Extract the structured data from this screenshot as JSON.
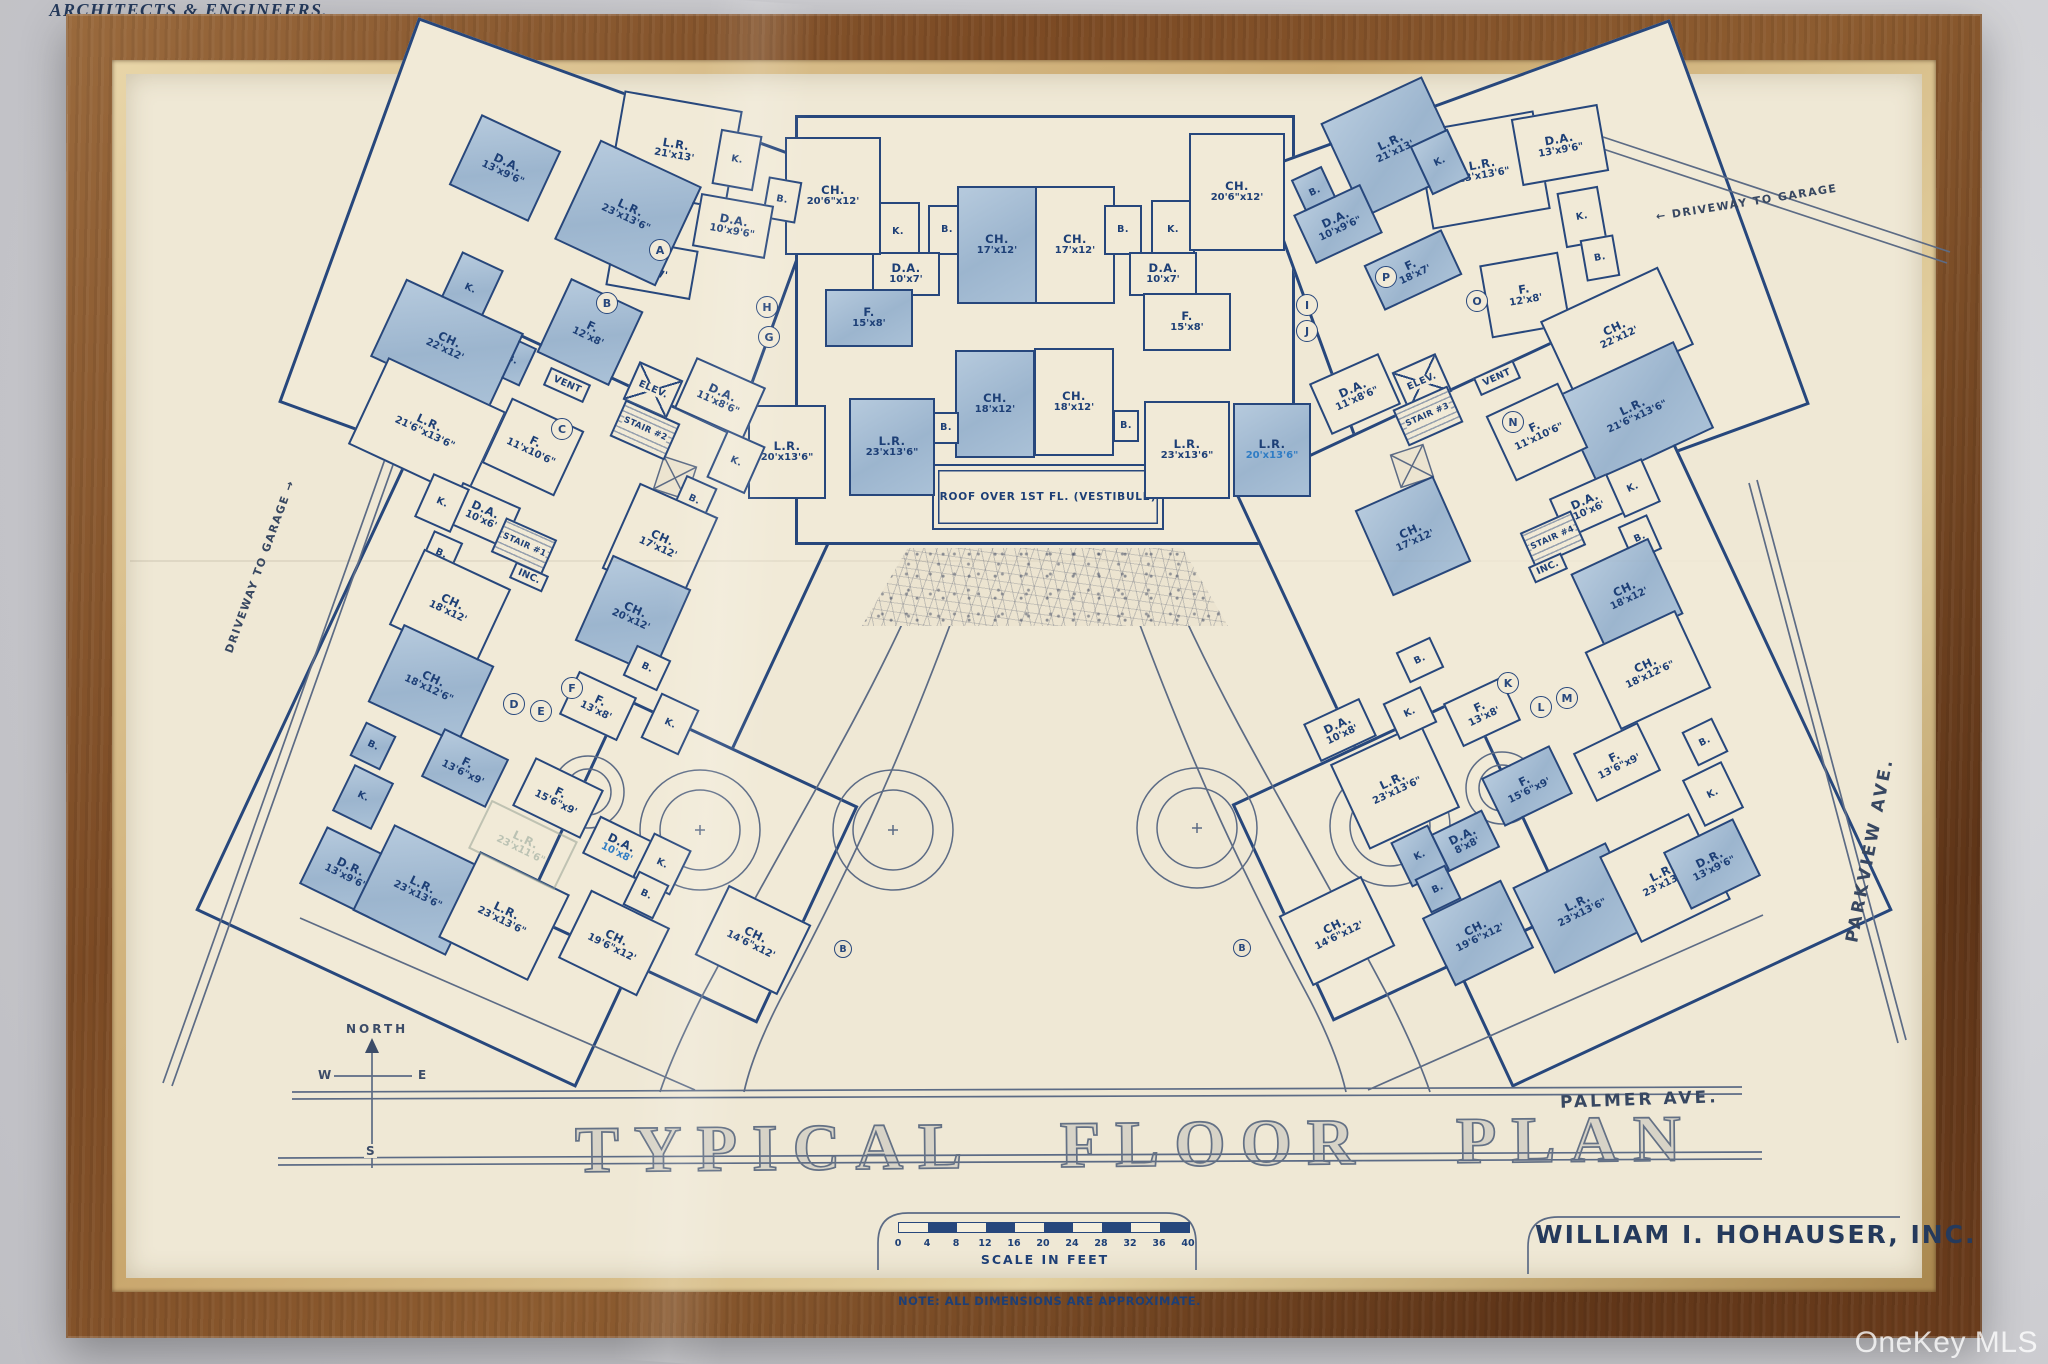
{
  "title": {
    "text": "TYPICAL FLOOR PLAN"
  },
  "firm": {
    "name": "WILLIAM I. HOHAUSER, INC.",
    "tagline": "ARCHITECTS & ENGINEERS,"
  },
  "note": "NOTE: ALL DIMENSIONS ARE APPROXIMATE.",
  "scale": {
    "label": "SCALE IN FEET",
    "ticks": [
      0,
      4,
      8,
      12,
      16,
      20,
      24,
      28,
      32,
      36,
      40
    ]
  },
  "streets": {
    "palmer": "PALMER AVE.",
    "parkview": "PARKVIEW AVE.",
    "driveway_right": "← DRIVEWAY TO GARAGE",
    "driveway_left": "DRIVEWAY TO GARAGE →"
  },
  "compass": {
    "north": "NORTH",
    "w": "W",
    "e": "E",
    "s": "S"
  },
  "vestibule": "ROOF OVER 1ST FL. (VESTIBULE)",
  "watermark": "OneKey MLS",
  "colors": {
    "ink": "#27477c",
    "wash": "#a7bed8",
    "paper": "#efe8d5",
    "wood": "#7b4a24"
  },
  "rooms": [
    {
      "x": 898,
      "y": 232,
      "w": 44,
      "h": 60,
      "a": 0,
      "s": "c",
      "l": "K."
    },
    {
      "x": 947,
      "y": 230,
      "w": 38,
      "h": 50,
      "a": 0,
      "s": "c",
      "l": "B."
    },
    {
      "x": 906,
      "y": 274,
      "w": 68,
      "h": 44,
      "a": 0,
      "s": "c",
      "l": "D.A.",
      "d": "10'x7'"
    },
    {
      "x": 997,
      "y": 245,
      "w": 80,
      "h": 118,
      "a": 0,
      "s": "b",
      "l": "CH.",
      "d": "17'x12'"
    },
    {
      "x": 1075,
      "y": 245,
      "w": 80,
      "h": 118,
      "a": 0,
      "s": "c",
      "l": "CH.",
      "d": "17'x12'"
    },
    {
      "x": 1123,
      "y": 230,
      "w": 38,
      "h": 50,
      "a": 0,
      "s": "c",
      "l": "B."
    },
    {
      "x": 1173,
      "y": 230,
      "w": 44,
      "h": 60,
      "a": 0,
      "s": "c",
      "l": "K."
    },
    {
      "x": 1163,
      "y": 274,
      "w": 68,
      "h": 44,
      "a": 0,
      "s": "c",
      "l": "D.A.",
      "d": "10'x7'"
    },
    {
      "x": 833,
      "y": 196,
      "w": 96,
      "h": 118,
      "a": 0,
      "s": "c",
      "l": "CH.",
      "d": "20'6\"x12'"
    },
    {
      "x": 1237,
      "y": 192,
      "w": 96,
      "h": 118,
      "a": 0,
      "s": "c",
      "l": "CH.",
      "d": "20'6\"x12'"
    },
    {
      "x": 869,
      "y": 318,
      "w": 88,
      "h": 58,
      "a": 0,
      "s": "b",
      "l": "F.",
      "d": "15'x8'"
    },
    {
      "x": 1187,
      "y": 322,
      "w": 88,
      "h": 58,
      "a": 0,
      "s": "c",
      "l": "F.",
      "d": "15'x8'"
    },
    {
      "x": 995,
      "y": 404,
      "w": 80,
      "h": 108,
      "a": 0,
      "s": "b",
      "l": "CH.",
      "d": "18'x12'"
    },
    {
      "x": 1074,
      "y": 402,
      "w": 80,
      "h": 108,
      "a": 0,
      "s": "c",
      "l": "CH.",
      "d": "18'x12'"
    },
    {
      "x": 946,
      "y": 428,
      "w": 26,
      "h": 32,
      "a": 0,
      "s": "c",
      "l": "B."
    },
    {
      "x": 1126,
      "y": 426,
      "w": 26,
      "h": 32,
      "a": 0,
      "s": "c",
      "l": "B."
    },
    {
      "x": 892,
      "y": 447,
      "w": 86,
      "h": 98,
      "a": 0,
      "s": "b",
      "l": "L.R.",
      "d": "23'x13'6\""
    },
    {
      "x": 1187,
      "y": 450,
      "w": 86,
      "h": 98,
      "a": 0,
      "s": "c",
      "l": "L.R.",
      "d": "23'x13'6\""
    },
    {
      "x": 787,
      "y": 452,
      "w": 78,
      "h": 94,
      "a": 0,
      "s": "c",
      "l": "L.R.",
      "d": "20'x13'6\""
    },
    {
      "x": 1272,
      "y": 450,
      "w": 78,
      "h": 94,
      "a": 0,
      "s": "b",
      "l": "L.R.",
      "d": "20'x13'6\"",
      "corr": true
    },
    {
      "x": 675,
      "y": 150,
      "w": 120,
      "h": 100,
      "a": 10,
      "s": "c",
      "l": "L.R.",
      "d": "21'x13'"
    },
    {
      "x": 737,
      "y": 160,
      "w": 42,
      "h": 56,
      "a": 10,
      "s": "c",
      "l": "K."
    },
    {
      "x": 782,
      "y": 200,
      "w": 34,
      "h": 42,
      "a": 10,
      "s": "c",
      "l": "B."
    },
    {
      "x": 733,
      "y": 226,
      "w": 74,
      "h": 54,
      "a": 10,
      "s": "c",
      "l": "D.A.",
      "d": "10'x9'6\""
    },
    {
      "x": 652,
      "y": 268,
      "w": 86,
      "h": 50,
      "a": 10,
      "s": "c",
      "l": "F.",
      "d": "18'x7'"
    },
    {
      "x": 505,
      "y": 168,
      "w": 88,
      "h": 78,
      "a": 25,
      "s": "b",
      "l": "D.A.",
      "d": "13'x9'6\""
    },
    {
      "x": 628,
      "y": 213,
      "w": 112,
      "h": 110,
      "a": 25,
      "s": "b",
      "l": "L.R.",
      "d": "23'x13'6\""
    },
    {
      "x": 470,
      "y": 289,
      "w": 46,
      "h": 62,
      "a": 25,
      "s": "b",
      "l": "K."
    },
    {
      "x": 512,
      "y": 360,
      "w": 36,
      "h": 42,
      "a": 25,
      "s": "b",
      "l": "B."
    },
    {
      "x": 590,
      "y": 332,
      "w": 80,
      "h": 82,
      "a": 25,
      "s": "b",
      "l": "F.",
      "d": "12'x8'"
    },
    {
      "x": 447,
      "y": 345,
      "w": 130,
      "h": 86,
      "a": 25,
      "s": "b",
      "l": "CH.",
      "d": "22'x12'"
    },
    {
      "x": 427,
      "y": 428,
      "w": 130,
      "h": 96,
      "a": 25,
      "s": "c",
      "l": "L.R.",
      "d": "21'6\"x13'6\""
    },
    {
      "x": 533,
      "y": 447,
      "w": 80,
      "h": 72,
      "a": 25,
      "s": "c",
      "l": "F.",
      "d": "11'x10'6\""
    },
    {
      "x": 567,
      "y": 385,
      "w": 44,
      "h": 20,
      "a": 24,
      "s": "v",
      "l": "VENT"
    },
    {
      "x": 653,
      "y": 390,
      "w": 48,
      "h": 42,
      "a": 24,
      "s": "e",
      "l": "ELEV."
    },
    {
      "x": 645,
      "y": 430,
      "w": 60,
      "h": 40,
      "a": 24,
      "s": "t",
      "l": "STAIR #2"
    },
    {
      "x": 720,
      "y": 398,
      "w": 76,
      "h": 56,
      "a": 24,
      "s": "c",
      "l": "D.A.",
      "d": "11'x8'6\""
    },
    {
      "x": 736,
      "y": 462,
      "w": 42,
      "h": 52,
      "a": 24,
      "s": "c",
      "l": "K."
    },
    {
      "x": 694,
      "y": 500,
      "w": 34,
      "h": 40,
      "a": 24,
      "s": "c",
      "l": "B."
    },
    {
      "x": 660,
      "y": 543,
      "w": 86,
      "h": 94,
      "a": 24,
      "s": "c",
      "l": "CH.",
      "d": "17'x12'"
    },
    {
      "x": 633,
      "y": 615,
      "w": 86,
      "h": 94,
      "a": 24,
      "s": "b",
      "l": "CH.",
      "d": "20'x12'"
    },
    {
      "x": 483,
      "y": 515,
      "w": 64,
      "h": 44,
      "a": 24,
      "s": "c",
      "l": "D.A.",
      "d": "10'x6'"
    },
    {
      "x": 442,
      "y": 503,
      "w": 40,
      "h": 48,
      "a": 24,
      "s": "c",
      "l": "K."
    },
    {
      "x": 441,
      "y": 554,
      "w": 32,
      "h": 38,
      "a": 24,
      "s": "c",
      "l": "B."
    },
    {
      "x": 524,
      "y": 546,
      "w": 56,
      "h": 38,
      "a": 24,
      "s": "t",
      "l": "STAIR #1"
    },
    {
      "x": 529,
      "y": 577,
      "w": 36,
      "h": 18,
      "a": 24,
      "s": "v",
      "l": "INC."
    },
    {
      "x": 450,
      "y": 607,
      "w": 96,
      "h": 84,
      "a": 25,
      "s": "c",
      "l": "CH.",
      "d": "18'x12'"
    },
    {
      "x": 431,
      "y": 684,
      "w": 100,
      "h": 86,
      "a": 25,
      "s": "b",
      "l": "CH.",
      "d": "18'x12'6\""
    },
    {
      "x": 373,
      "y": 746,
      "w": 34,
      "h": 38,
      "a": 26,
      "s": "b",
      "l": "B."
    },
    {
      "x": 363,
      "y": 797,
      "w": 44,
      "h": 52,
      "a": 26,
      "s": "b",
      "l": "K."
    },
    {
      "x": 348,
      "y": 872,
      "w": 78,
      "h": 64,
      "a": 26,
      "s": "b",
      "l": "D.R.",
      "d": "13'x9'6\""
    },
    {
      "x": 420,
      "y": 890,
      "w": 104,
      "h": 96,
      "a": 26,
      "s": "b",
      "l": "L.R.",
      "d": "23'x13'6\""
    },
    {
      "x": 504,
      "y": 916,
      "w": 100,
      "h": 96,
      "a": 26,
      "s": "c",
      "l": "L.R.",
      "d": "23'x13'6\""
    },
    {
      "x": 523,
      "y": 845,
      "w": 96,
      "h": 54,
      "a": 26,
      "s": "g",
      "l": "L.R.",
      "d": "23'x11'6\""
    },
    {
      "x": 465,
      "y": 768,
      "w": 72,
      "h": 54,
      "a": 26,
      "s": "b",
      "l": "F.",
      "d": "13'6\"x9'"
    },
    {
      "x": 558,
      "y": 798,
      "w": 76,
      "h": 54,
      "a": 26,
      "s": "c",
      "l": "F.",
      "d": "15'6\"x9'"
    },
    {
      "x": 619,
      "y": 848,
      "w": 62,
      "h": 42,
      "a": 26,
      "s": "c",
      "l": "D.A.",
      "d": "10'x8'",
      "corr": true
    },
    {
      "x": 662,
      "y": 864,
      "w": 42,
      "h": 50,
      "a": 26,
      "s": "c",
      "l": "K."
    },
    {
      "x": 646,
      "y": 895,
      "w": 34,
      "h": 38,
      "a": 26,
      "s": "c",
      "l": "B."
    },
    {
      "x": 614,
      "y": 943,
      "w": 88,
      "h": 76,
      "a": 26,
      "s": "c",
      "l": "CH.",
      "d": "19'6\"x12'"
    },
    {
      "x": 753,
      "y": 940,
      "w": 92,
      "h": 78,
      "a": 26,
      "s": "c",
      "l": "CH.",
      "d": "14'6\"x12'"
    },
    {
      "x": 598,
      "y": 706,
      "w": 64,
      "h": 48,
      "a": 25,
      "s": "c",
      "l": "F.",
      "d": "13'x8'"
    },
    {
      "x": 670,
      "y": 724,
      "w": 42,
      "h": 50,
      "a": 25,
      "s": "c",
      "l": "K."
    },
    {
      "x": 647,
      "y": 668,
      "w": 38,
      "h": 34,
      "a": 25,
      "s": "c",
      "l": "B."
    },
    {
      "x": 1483,
      "y": 170,
      "w": 120,
      "h": 100,
      "a": -10,
      "s": "c",
      "l": "L.R.",
      "d": "23'x13'6\""
    },
    {
      "x": 1560,
      "y": 145,
      "w": 88,
      "h": 68,
      "a": -10,
      "s": "c",
      "l": "D.A.",
      "d": "13'x9'6\""
    },
    {
      "x": 1582,
      "y": 217,
      "w": 42,
      "h": 56,
      "a": -10,
      "s": "c",
      "l": "K."
    },
    {
      "x": 1600,
      "y": 258,
      "w": 34,
      "h": 42,
      "a": -10,
      "s": "c",
      "l": "B."
    },
    {
      "x": 1525,
      "y": 295,
      "w": 80,
      "h": 74,
      "a": -10,
      "s": "c",
      "l": "F.",
      "d": "12'x8'"
    },
    {
      "x": 1617,
      "y": 333,
      "w": 130,
      "h": 86,
      "a": -25,
      "s": "c",
      "l": "CH.",
      "d": "22'x12'"
    },
    {
      "x": 1393,
      "y": 147,
      "w": 112,
      "h": 104,
      "a": -25,
      "s": "b",
      "l": "L.R.",
      "d": "21'x13'"
    },
    {
      "x": 1440,
      "y": 162,
      "w": 42,
      "h": 54,
      "a": -25,
      "s": "b",
      "l": "K."
    },
    {
      "x": 1315,
      "y": 192,
      "w": 34,
      "h": 42,
      "a": -25,
      "s": "b",
      "l": "B."
    },
    {
      "x": 1338,
      "y": 224,
      "w": 74,
      "h": 54,
      "a": -25,
      "s": "b",
      "l": "D.A.",
      "d": "10'x9'6\""
    },
    {
      "x": 1413,
      "y": 270,
      "w": 86,
      "h": 50,
      "a": -25,
      "s": "b",
      "l": "F.",
      "d": "18'x7'"
    },
    {
      "x": 1635,
      "y": 412,
      "w": 130,
      "h": 96,
      "a": -25,
      "s": "b",
      "l": "L.R.",
      "d": "21'6\"x13'6\""
    },
    {
      "x": 1537,
      "y": 432,
      "w": 80,
      "h": 72,
      "a": -25,
      "s": "c",
      "l": "F.",
      "d": "11'x10'6\""
    },
    {
      "x": 1497,
      "y": 378,
      "w": 44,
      "h": 20,
      "a": -24,
      "s": "v",
      "l": "VENT"
    },
    {
      "x": 1422,
      "y": 382,
      "w": 48,
      "h": 42,
      "a": -24,
      "s": "e",
      "l": "ELEV."
    },
    {
      "x": 1428,
      "y": 416,
      "w": 60,
      "h": 40,
      "a": -24,
      "s": "t",
      "l": "STAIR #3"
    },
    {
      "x": 1355,
      "y": 394,
      "w": 76,
      "h": 56,
      "a": -24,
      "s": "c",
      "l": "D.A.",
      "d": "11'x8'6\""
    },
    {
      "x": 1413,
      "y": 536,
      "w": 86,
      "h": 94,
      "a": -24,
      "s": "b",
      "l": "CH.",
      "d": "17'x12'"
    },
    {
      "x": 1587,
      "y": 506,
      "w": 64,
      "h": 44,
      "a": -24,
      "s": "c",
      "l": "D.A.",
      "d": "10'x6'"
    },
    {
      "x": 1633,
      "y": 488,
      "w": 40,
      "h": 48,
      "a": -24,
      "s": "c",
      "l": "K."
    },
    {
      "x": 1640,
      "y": 538,
      "w": 32,
      "h": 38,
      "a": -24,
      "s": "c",
      "l": "B."
    },
    {
      "x": 1553,
      "y": 539,
      "w": 56,
      "h": 38,
      "a": -24,
      "s": "t",
      "l": "STAIR #4"
    },
    {
      "x": 1548,
      "y": 568,
      "w": 36,
      "h": 18,
      "a": -24,
      "s": "v",
      "l": "INC."
    },
    {
      "x": 1627,
      "y": 594,
      "w": 86,
      "h": 84,
      "a": -25,
      "s": "b",
      "l": "CH.",
      "d": "18'x12'"
    },
    {
      "x": 1648,
      "y": 670,
      "w": 100,
      "h": 86,
      "a": -25,
      "s": "c",
      "l": "CH.",
      "d": "18'x12'6\""
    },
    {
      "x": 1340,
      "y": 730,
      "w": 62,
      "h": 42,
      "a": -25,
      "s": "c",
      "l": "D.A.",
      "d": "10'x8'"
    },
    {
      "x": 1395,
      "y": 786,
      "w": 100,
      "h": 94,
      "a": -25,
      "s": "c",
      "l": "L.R.",
      "d": "23'x13'6\""
    },
    {
      "x": 1410,
      "y": 713,
      "w": 42,
      "h": 40,
      "a": -25,
      "s": "c",
      "l": "K."
    },
    {
      "x": 1420,
      "y": 660,
      "w": 38,
      "h": 34,
      "a": -25,
      "s": "c",
      "l": "B."
    },
    {
      "x": 1482,
      "y": 712,
      "w": 64,
      "h": 48,
      "a": -25,
      "s": "c",
      "l": "F.",
      "d": "13'x8'"
    },
    {
      "x": 1617,
      "y": 762,
      "w": 72,
      "h": 54,
      "a": -26,
      "s": "c",
      "l": "F.",
      "d": "13'6\"x9'"
    },
    {
      "x": 1527,
      "y": 786,
      "w": 76,
      "h": 54,
      "a": -26,
      "s": "b",
      "l": "F.",
      "d": "15'6\"x9'"
    },
    {
      "x": 1465,
      "y": 841,
      "w": 58,
      "h": 42,
      "a": -26,
      "s": "b",
      "l": "D.A.",
      "d": "8'x8'"
    },
    {
      "x": 1420,
      "y": 856,
      "w": 42,
      "h": 50,
      "a": -26,
      "s": "b",
      "l": "K."
    },
    {
      "x": 1438,
      "y": 889,
      "w": 34,
      "h": 38,
      "a": -26,
      "s": "b",
      "l": "B."
    },
    {
      "x": 1478,
      "y": 933,
      "w": 88,
      "h": 76,
      "a": -26,
      "s": "b",
      "l": "CH.",
      "d": "19'6\"x12'"
    },
    {
      "x": 1337,
      "y": 931,
      "w": 92,
      "h": 78,
      "a": -26,
      "s": "c",
      "l": "CH.",
      "d": "14'6\"x12'"
    },
    {
      "x": 1580,
      "y": 908,
      "w": 104,
      "h": 96,
      "a": -26,
      "s": "b",
      "l": "L.R.",
      "d": "23'x13'6\""
    },
    {
      "x": 1665,
      "y": 878,
      "w": 100,
      "h": 96,
      "a": -26,
      "s": "c",
      "l": "L.R.",
      "d": "23'x13'6\""
    },
    {
      "x": 1712,
      "y": 864,
      "w": 78,
      "h": 64,
      "a": -26,
      "s": "b",
      "l": "D.R.",
      "d": "13'x9'6\""
    },
    {
      "x": 1705,
      "y": 742,
      "w": 34,
      "h": 38,
      "a": -26,
      "s": "c",
      "l": "B."
    },
    {
      "x": 1713,
      "y": 794,
      "w": 44,
      "h": 52,
      "a": -26,
      "s": "c",
      "l": "K."
    }
  ],
  "markers": [
    {
      "x": 660,
      "y": 250,
      "t": "A"
    },
    {
      "x": 607,
      "y": 303,
      "t": "B"
    },
    {
      "x": 562,
      "y": 429,
      "t": "C"
    },
    {
      "x": 514,
      "y": 704,
      "t": "D"
    },
    {
      "x": 541,
      "y": 711,
      "t": "E"
    },
    {
      "x": 572,
      "y": 688,
      "t": "F"
    },
    {
      "x": 769,
      "y": 337,
      "t": "G"
    },
    {
      "x": 767,
      "y": 307,
      "t": "H"
    },
    {
      "x": 1307,
      "y": 305,
      "t": "I"
    },
    {
      "x": 1307,
      "y": 331,
      "t": "J"
    },
    {
      "x": 1508,
      "y": 683,
      "t": "K"
    },
    {
      "x": 1541,
      "y": 707,
      "t": "L"
    },
    {
      "x": 1567,
      "y": 698,
      "t": "M"
    },
    {
      "x": 1513,
      "y": 422,
      "t": "N"
    },
    {
      "x": 1477,
      "y": 301,
      "t": "O"
    },
    {
      "x": 1386,
      "y": 277,
      "t": "P"
    }
  ],
  "path_markers": [
    {
      "x": 843,
      "y": 949,
      "t": "B"
    },
    {
      "x": 1242,
      "y": 948,
      "t": "B"
    }
  ]
}
